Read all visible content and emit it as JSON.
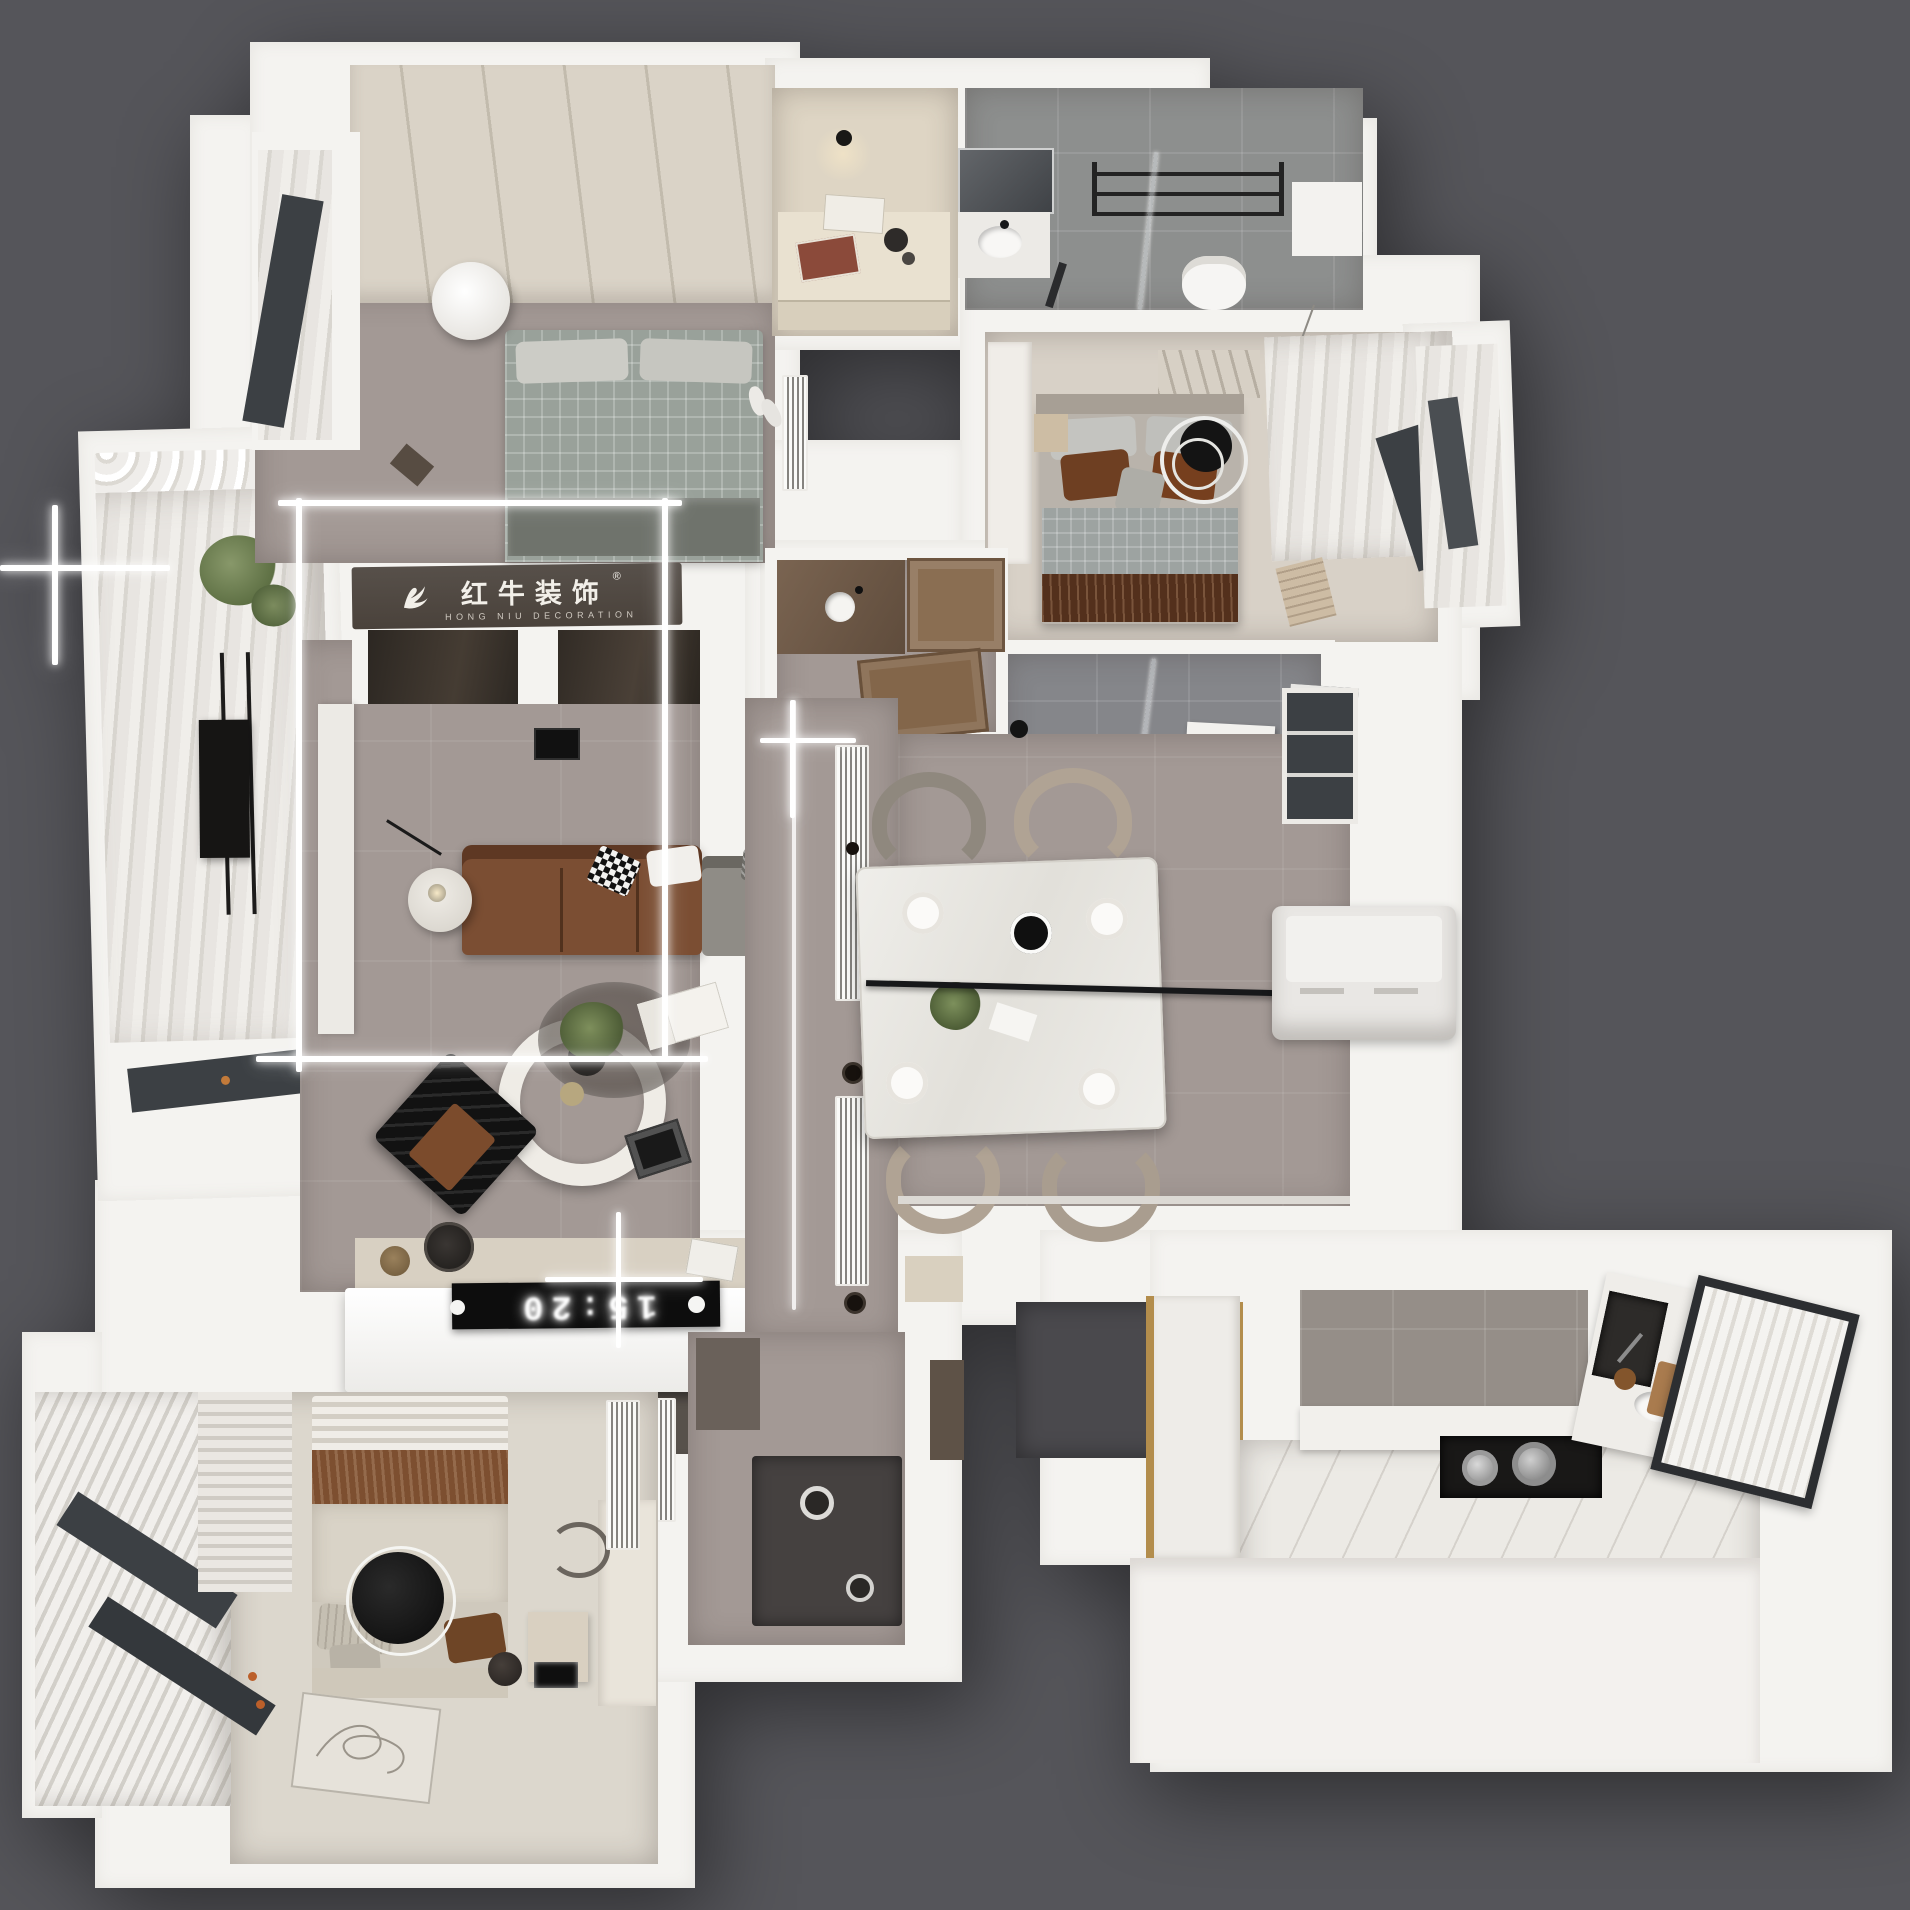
{
  "branding": {
    "logo_cn": "红牛装饰",
    "logo_en": "HONG NIU DECORATION",
    "registered": "®",
    "logo_icon": "hongniu-bird-logo"
  },
  "displays": {
    "tv_clock": "15:20"
  },
  "palette": {
    "bg": "#55555a",
    "wall": "#f4f3f0",
    "mauve": "#a39995",
    "cream": "#dcd6cc",
    "beige": "#ded5c3",
    "bath_gray": "#8d8f8e",
    "banner": "#4a423b",
    "banner_text": "#f2efe9",
    "sofa": "#7b4e33",
    "black": "#161514",
    "marble": "#ecebe7",
    "green": "#6f7f52",
    "brass": "#b38d4c",
    "fridge": "#e9e7e4",
    "tray": "#454140",
    "window": "#3c4044",
    "wood": "#8a6e52",
    "glow": "#ffffff"
  }
}
